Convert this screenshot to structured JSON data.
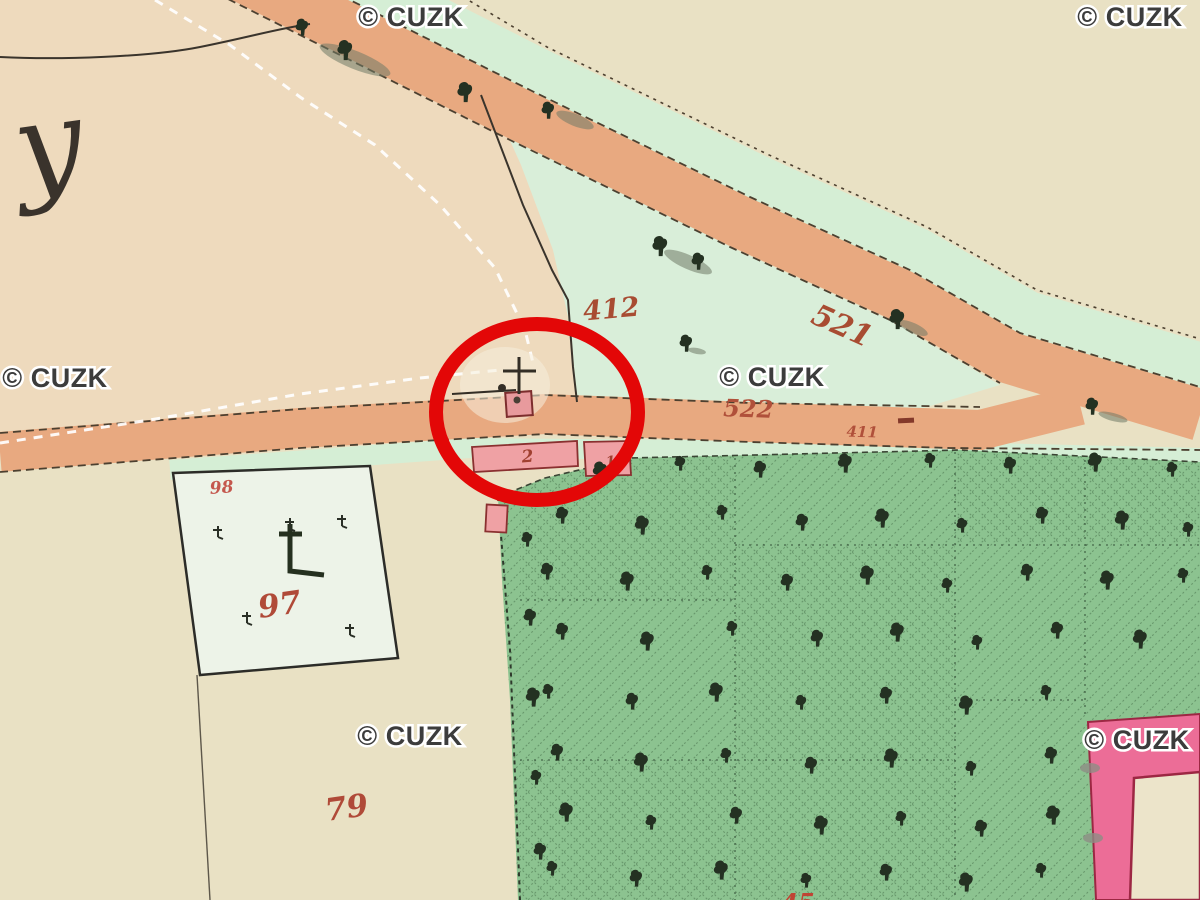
{
  "map": {
    "type": "historical-cadastral-map",
    "watermarks": {
      "text": "© CUZK",
      "color": "#3c3c3c",
      "positions": [
        [
          411,
          26
        ],
        [
          1130,
          26
        ],
        [
          55,
          387
        ],
        [
          772,
          386
        ],
        [
          410,
          745
        ],
        [
          1137,
          749
        ]
      ]
    },
    "script_letter": {
      "text": "y"
    },
    "labels": [
      {
        "text": "412",
        "x": 612,
        "y": 318,
        "size": 27,
        "rot": -5,
        "color": "#a84c32"
      },
      {
        "text": "521",
        "x": 838,
        "y": 335,
        "size": 30,
        "rot": 24,
        "color": "#a84c32"
      },
      {
        "text": "522",
        "x": 748,
        "y": 417,
        "size": 24,
        "rot": 2,
        "color": "#b0503a"
      },
      {
        "text": "411",
        "x": 862,
        "y": 437,
        "size": 15,
        "rot": 2,
        "color": "#b0503a"
      },
      {
        "text": "98",
        "x": 222,
        "y": 493,
        "size": 17,
        "rot": -4,
        "color": "#c4574d"
      },
      {
        "text": "97",
        "x": 281,
        "y": 615,
        "size": 31,
        "rot": -8,
        "color": "#b04a38"
      },
      {
        "text": "79",
        "x": 348,
        "y": 818,
        "size": 31,
        "rot": -8,
        "color": "#b04a38"
      },
      {
        "text": "2",
        "x": 528,
        "y": 462,
        "size": 17,
        "rot": -5,
        "color": "#a04030"
      },
      {
        "text": "1",
        "x": 611,
        "y": 466,
        "size": 14,
        "rot": -5,
        "color": "#a04030"
      },
      {
        "text": "45",
        "x": 798,
        "y": 911,
        "size": 24,
        "rot": 0,
        "color": "#c04434"
      }
    ],
    "colors": {
      "paper": "#e9e1c4",
      "field": "#eedabd",
      "meadow": "#d9eed9",
      "road": "#e7a87d",
      "forest": "#8cc390",
      "building_small": "#efa1a4",
      "building_large": "#ec6d97",
      "annotation": "#e30707"
    },
    "annotation_circle": {
      "cx": 537,
      "cy": 412,
      "rx": 101,
      "ry": 88,
      "stroke_width": 14
    },
    "forest_trees": [
      [
        527,
        540
      ],
      [
        530,
        618
      ],
      [
        533,
        698
      ],
      [
        536,
        778
      ],
      [
        540,
        852
      ],
      [
        600,
        472
      ],
      [
        680,
        464
      ],
      [
        760,
        470
      ],
      [
        845,
        464
      ],
      [
        930,
        461
      ],
      [
        1010,
        466
      ],
      [
        1095,
        463
      ],
      [
        1172,
        470
      ],
      [
        562,
        516
      ],
      [
        642,
        526
      ],
      [
        722,
        513
      ],
      [
        802,
        523
      ],
      [
        882,
        519
      ],
      [
        962,
        526
      ],
      [
        1042,
        516
      ],
      [
        1122,
        521
      ],
      [
        1188,
        530
      ],
      [
        547,
        572
      ],
      [
        627,
        582
      ],
      [
        707,
        573
      ],
      [
        787,
        583
      ],
      [
        867,
        576
      ],
      [
        947,
        586
      ],
      [
        1027,
        573
      ],
      [
        1107,
        581
      ],
      [
        1183,
        576
      ],
      [
        562,
        632
      ],
      [
        647,
        642
      ],
      [
        732,
        629
      ],
      [
        817,
        639
      ],
      [
        897,
        633
      ],
      [
        977,
        643
      ],
      [
        1057,
        631
      ],
      [
        1140,
        640
      ],
      [
        548,
        692
      ],
      [
        632,
        702
      ],
      [
        716,
        693
      ],
      [
        801,
        703
      ],
      [
        886,
        696
      ],
      [
        966,
        706
      ],
      [
        1046,
        693
      ],
      [
        557,
        753
      ],
      [
        641,
        763
      ],
      [
        726,
        756
      ],
      [
        811,
        766
      ],
      [
        891,
        759
      ],
      [
        971,
        769
      ],
      [
        1051,
        756
      ],
      [
        566,
        813
      ],
      [
        651,
        823
      ],
      [
        736,
        816
      ],
      [
        821,
        826
      ],
      [
        901,
        819
      ],
      [
        981,
        829
      ],
      [
        1053,
        816
      ],
      [
        552,
        869
      ],
      [
        636,
        879
      ],
      [
        721,
        871
      ],
      [
        806,
        881
      ],
      [
        886,
        873
      ],
      [
        966,
        883
      ],
      [
        1041,
        871
      ]
    ],
    "road_trees": [
      [
        302,
        28
      ],
      [
        345,
        51
      ],
      [
        548,
        111
      ],
      [
        660,
        247
      ],
      [
        698,
        262
      ],
      [
        897,
        320
      ],
      [
        1092,
        407
      ],
      [
        465,
        93
      ],
      [
        686,
        344
      ]
    ],
    "shadows": [
      [
        355,
        60,
        38,
        9,
        22
      ],
      [
        575,
        120,
        20,
        6,
        22
      ],
      [
        688,
        262,
        26,
        7,
        24
      ],
      [
        913,
        328,
        16,
        5,
        24
      ],
      [
        1113,
        417,
        15,
        4,
        15
      ],
      [
        697,
        351,
        9,
        3,
        10
      ]
    ],
    "garden_trees": [
      [
        218,
        532
      ],
      [
        290,
        524
      ],
      [
        342,
        521
      ],
      [
        247,
        618
      ],
      [
        350,
        630
      ]
    ]
  }
}
